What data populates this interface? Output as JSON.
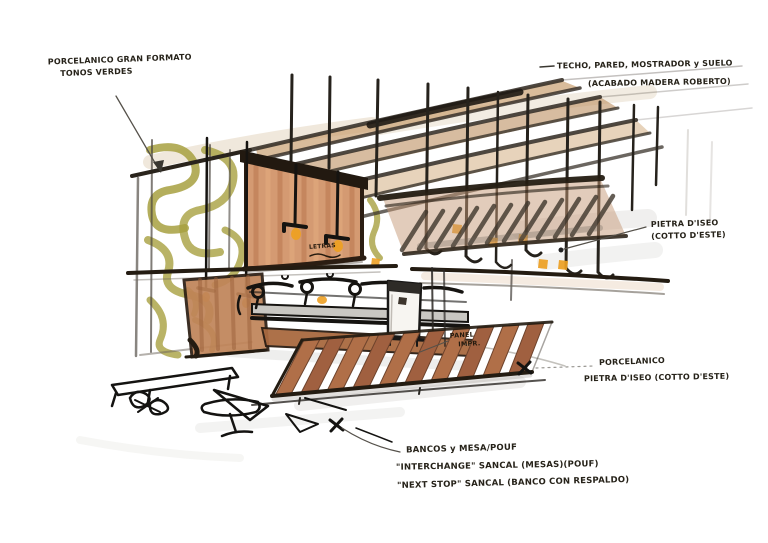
{
  "title": "interior design marker sketch with material annotations",
  "annotations": {
    "top_left": {
      "line1": "PORCELANICO GRAN FORMATO",
      "line2": "TONOS VERDES"
    },
    "top_right": {
      "line1": "TECHO, PARED, MOSTRADOR y SUELO",
      "line2": "(ACABADO MADERA ROBERTO)"
    },
    "right": {
      "line1": "PIETRA D'ISEO",
      "line2": "(COTTO D'ESTE)"
    },
    "bottom_right": {
      "line1": "PORCELANICO",
      "line2": "PIETRA D'ISEO (COTTO D'ESTE)"
    },
    "bottom": {
      "line1": "BANCOS y MESA/POUF",
      "line2": "\"INTERCHANGE\" SANCAL (MESAS)(POUF)",
      "line3": "\"NEXT STOP\" SANCAL (BANCO CON RESPALDO)"
    },
    "panel_label": {
      "line1": "PANEL",
      "line2": "IMPR."
    },
    "letters_label": {
      "line1": "LETRAS"
    }
  },
  "palette": {
    "paper": "#ffffff",
    "ink": "#1c1b19",
    "olive_green": "#a7a040",
    "wood_light": "#d49a72",
    "wood_mid": "#b5714a",
    "wood_dark": "#8a5434",
    "accent_orange": "#eda023"
  }
}
